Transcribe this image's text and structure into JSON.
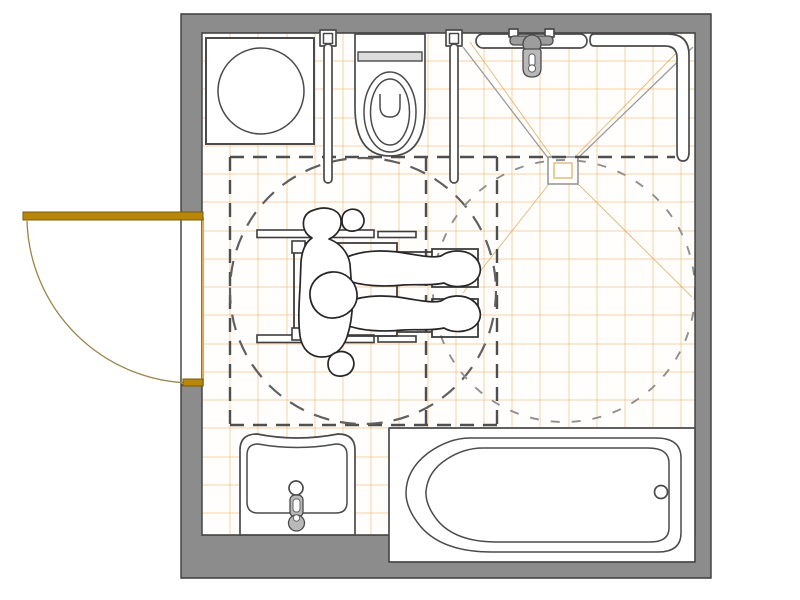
{
  "page": {
    "title": "Accessible Bathroom Floor Plan",
    "view": "architectural top view, no text labels"
  },
  "room": {
    "walls": "gray perimeter wall band, rectangular room",
    "door": {
      "location": "left wall",
      "swing": "quarter-circle opening outward",
      "leaf": "goldenrod door leaf shown open against outside wall"
    }
  },
  "fixtures": [
    {
      "id": "washing-machine",
      "location": "top-left",
      "shape": "square with drum circle"
    },
    {
      "id": "toilet",
      "location": "top-center",
      "details": "flush plate, body, seat ovals, U flush glyph"
    },
    {
      "id": "grab-rail-left-of-toilet",
      "location": "top wall",
      "details": "fold-down rail with wall mount"
    },
    {
      "id": "grab-rail-right-of-toilet",
      "location": "top wall",
      "details": "fold-down rail with wall mount"
    },
    {
      "id": "roll-in-shower",
      "location": "top-right",
      "details": "floor drain square, slope diagonals, straight grab bar, corner L grab bar, gray mixer valve with lever"
    },
    {
      "id": "washbasin",
      "location": "bottom-left",
      "details": "basin with gray single-lever tap"
    },
    {
      "id": "bathtub",
      "location": "bottom-right",
      "details": "rim and basin outlines, drain circle at right end"
    }
  ],
  "accessibility": {
    "wheelchair_user": "person seated in wheelchair, top view, facing right",
    "turning_circle_left": "dark long-dash circle",
    "turning_circle_right": "light short-dash circle",
    "clear_floor_space": "dark dashed rectangle with two internal dashed dividers and extended top boundary"
  },
  "floor": {
    "finish": "orange tile grid over white"
  },
  "colors": {
    "wall_gray": "#8c8c8c",
    "wall_outline": "#3c3c3c",
    "tile_orange": "#eea855",
    "tile_orange_strong": "#dcae62",
    "diag_gray": "#9b9b9b",
    "dash_dark": "#4e4e4e",
    "dash_mid": "#606060",
    "dash_light": "#8f8f8f",
    "fixture_stroke": "#4a4a4a",
    "metal_gray": "#9d9d9d",
    "metal_light": "#b9b9b9",
    "door_gold": "#b8860b",
    "door_arc": "#97854a"
  }
}
